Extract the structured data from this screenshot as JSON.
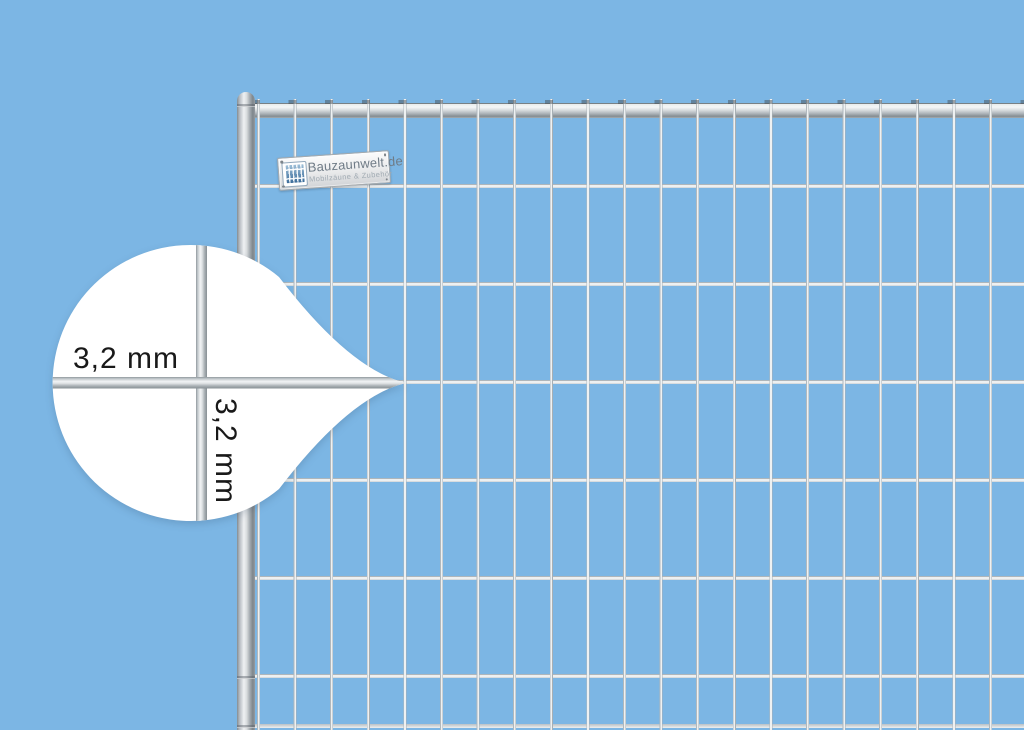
{
  "colors": {
    "background": "#7cb6e4",
    "callout-fill": "#ffffff",
    "label-text": "#191919",
    "steel-light": "#eff1f3",
    "steel-dark": "#848c91",
    "wire-light": "#eef1f2",
    "wire-dark": "#a7afb4",
    "logo-blue": "#9fc0d8",
    "plate-text": "#6f7b86",
    "plate-subtext": "#a0aab2"
  },
  "callout": {
    "horizontal_wire_label": "3,2 mm",
    "vertical_wire_label": "3,2 mm"
  },
  "brand_plate": {
    "name": "Bauzaunwelt.de",
    "tagline": "Mobilzäune & Zubehör"
  }
}
